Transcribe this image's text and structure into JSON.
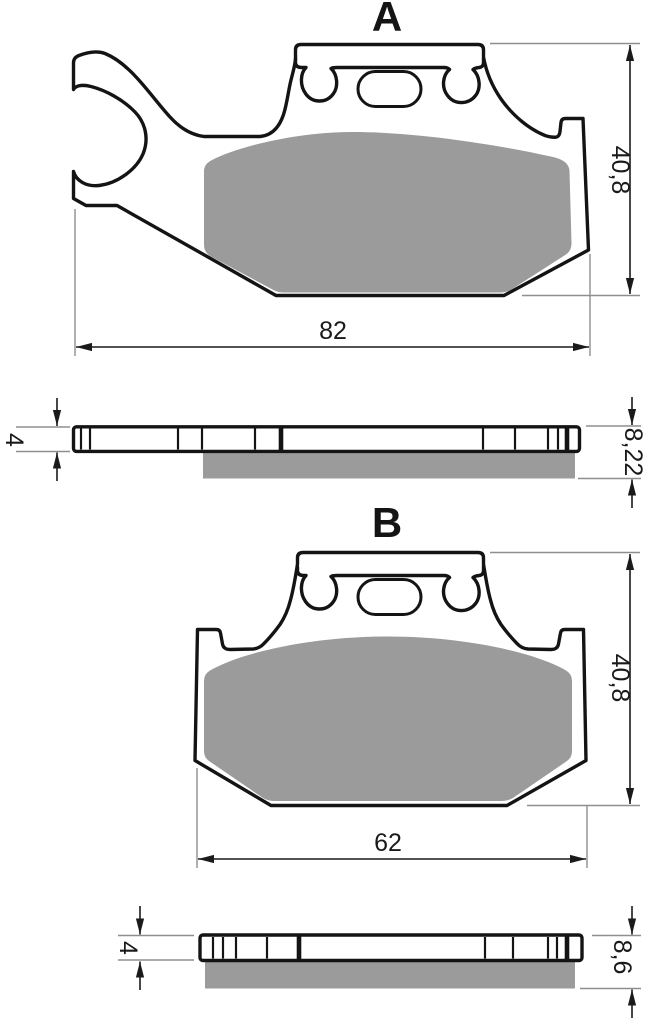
{
  "drawing": {
    "type": "brake-pad technical drawing, two variants with plan and section views",
    "background": "#ffffff"
  },
  "colors": {
    "pad": "#9b9b9b",
    "outline": "#141414",
    "dimension_line": "#1a1a1a",
    "extension_line": "#8f8f8f"
  },
  "sections": {
    "a": {
      "label": "A",
      "width_mm": "82",
      "height_mm": "40,8",
      "backplate_thickness_mm": "4",
      "total_thickness_mm": "8,22"
    },
    "b": {
      "label": "B",
      "width_mm": "62",
      "height_mm": "40,8",
      "backplate_thickness_mm": "4",
      "total_thickness_mm": "8,6"
    }
  }
}
